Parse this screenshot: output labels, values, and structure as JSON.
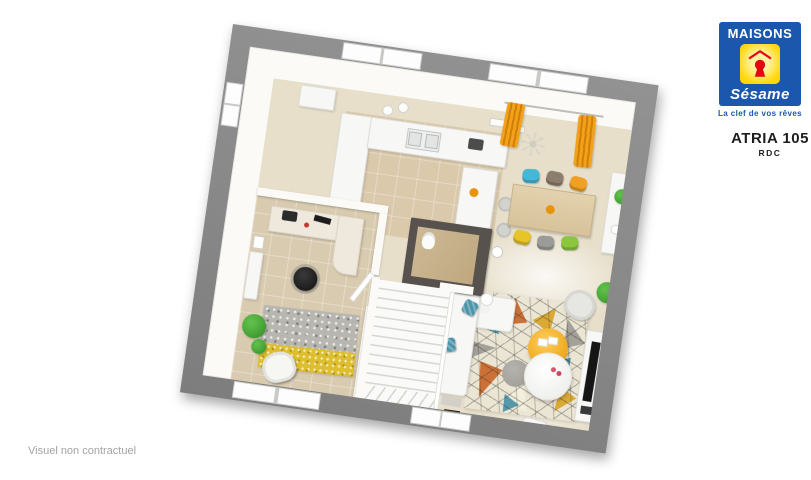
{
  "branding": {
    "maisons": "MAISONS",
    "sesame": "Sésame",
    "tagline": "La clef de vos rêves"
  },
  "header": {
    "title": "ATRIA 105",
    "subtitle": "RDC"
  },
  "footer": {
    "disclaimer": "Visuel non contractuel"
  },
  "floorplan": {
    "type": "3d-top-down-render",
    "rotation_deg": 8.2,
    "rooms": [
      "kitchen",
      "dining-area",
      "living-room",
      "office",
      "wc",
      "staircase",
      "entry-hall"
    ],
    "furniture": [
      "kitchen-counter",
      "kitchen-island",
      "bar-stools",
      "dining-table",
      "six-colored-chairs",
      "sideboard",
      "orange-curtains",
      "sofa",
      "geometric-rug",
      "orange-pouf",
      "coffee-table",
      "armchair",
      "tv-unit",
      "desk",
      "office-chair",
      "office-rug",
      "white-armchair",
      "plants",
      "stairs",
      "toilet"
    ]
  },
  "palette": {
    "blue": "#1b57ad",
    "yellow": "#ffd60a",
    "yellowLight": "#fff3a0",
    "red": "#e30613",
    "charcoal": "#57524d",
    "curtain": "#e8940f",
    "chairCyan": "#45b8d8",
    "chairTaupe": "#8d7d6e",
    "chairOrange": "#f0a125",
    "chairYellow": "#e7c428",
    "chairGray": "#9b9b98",
    "chairGreen": "#8cc63f",
    "plant": "#46a436",
    "rugTeal": "#4e93a8",
    "rugOrange": "#c96a2e",
    "rugMustard": "#d9a62e",
    "rugYellow": "#ddbe2e",
    "pouf": "#efaa1f"
  }
}
